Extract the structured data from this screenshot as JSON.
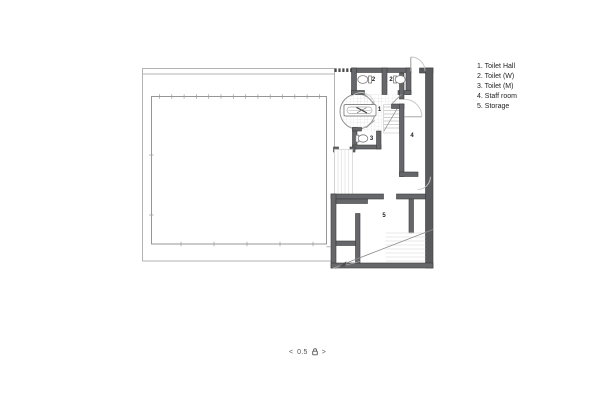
{
  "legend": {
    "items": [
      "1. Toilet Hall",
      "2. Toilet (W)",
      "3. Toilet (M)",
      "4. Staff room",
      "5. Storage"
    ]
  },
  "rooms": {
    "toilet_hall": "1",
    "toilet_w_left": "2",
    "toilet_w_right": "2",
    "toilet_m": "3",
    "staff_room": "4",
    "storage": "5"
  },
  "pager": {
    "prev": "<",
    "level": "0.5",
    "next": ">",
    "icon": "lock-icon"
  },
  "colors": {
    "wall": "#66676a",
    "wall_dark": "#595a5e",
    "outline_light": "#b3b3b3",
    "outline_mid": "#8c8c8c",
    "tile_grid": "#e4e4e4",
    "door_arc": "#c4c4c4",
    "text": "#242424"
  }
}
